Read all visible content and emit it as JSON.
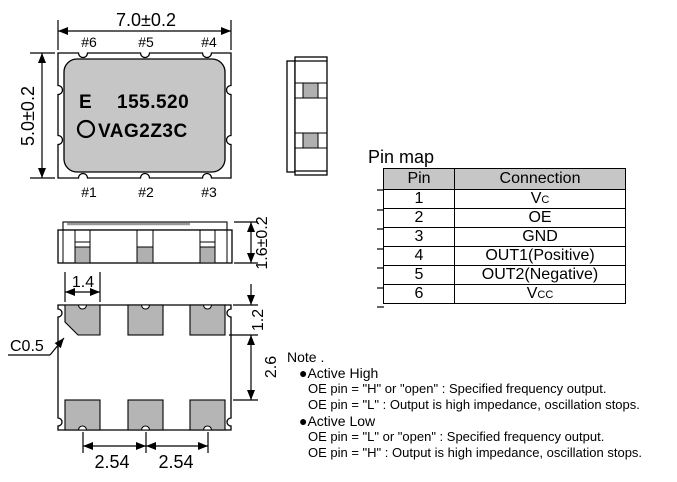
{
  "top_view": {
    "dim_width": "7.0±0.2",
    "dim_height": "5.0±0.2",
    "pin_labels_top": [
      "#6",
      "#5",
      "#4"
    ],
    "pin_labels_bottom": [
      "#1",
      "#2",
      "#3"
    ],
    "marking": {
      "line1_prefix": "E",
      "line1_value": "155.520",
      "line2": "VAG2Z3C"
    }
  },
  "front_view": {
    "dim_height": "1.6±0.2"
  },
  "land_pattern": {
    "dim_pad_width": "1.4",
    "dim_chamfer": "C0.5",
    "dim_pad_height": "1.2",
    "dim_row_gap": "2.6",
    "dim_pitch_left": "2.54",
    "dim_pitch_right": "2.54"
  },
  "pin_map": {
    "title": "Pin map",
    "headers": {
      "pin": "Pin",
      "connection": "Connection"
    },
    "rows": [
      {
        "pin": "1",
        "connection": "Vc"
      },
      {
        "pin": "2",
        "connection": "OE"
      },
      {
        "pin": "3",
        "connection": "GND"
      },
      {
        "pin": "4",
        "connection": "OUT1(Positive)"
      },
      {
        "pin": "5",
        "connection": "OUT2(Negative)"
      },
      {
        "pin": "6",
        "connection": "Vcc"
      }
    ]
  },
  "note": {
    "title": "Note .",
    "lines": [
      "●Active High",
      "OE pin = \"H\" or \"open\" : Specified frequency output.",
      "OE pin = \"L\" : Output is high impedance, oscillation stops.",
      "●Active Low",
      "OE pin = \"L\" or \"open\" : Specified frequency output.",
      "OE pin = \"H\" : Output is high impedance, oscillation stops."
    ]
  },
  "colors": {
    "body_fill": "#c6c6c6",
    "pad_fill": "#b5b5b5",
    "table_header_fill": "#c6c6c6",
    "line": "#000000"
  }
}
